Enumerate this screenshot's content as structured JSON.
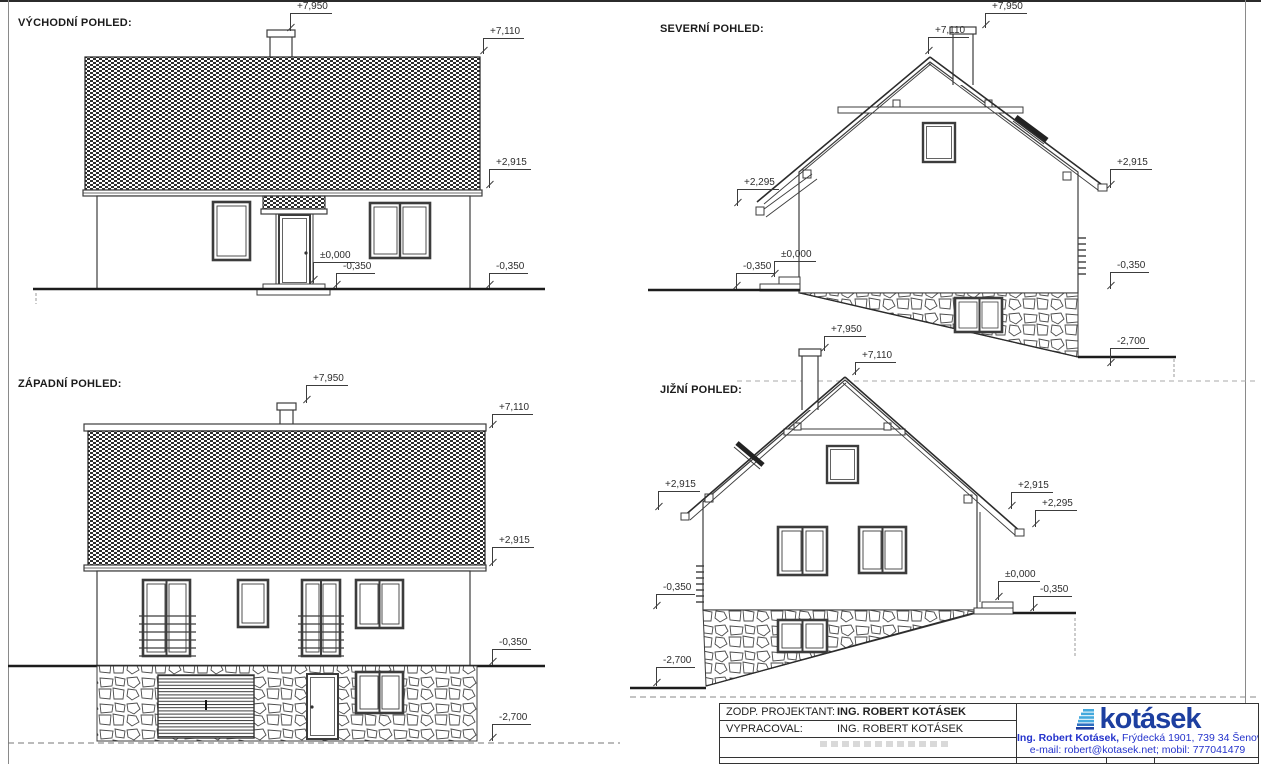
{
  "views": {
    "east": {
      "label": "VÝCHODNÍ POHLED:",
      "marks": {
        "chimney": "+7,950",
        "ridge": "+7,110",
        "eave": "+2,915",
        "zero": "±0,000",
        "ground_near": "-0,350",
        "ground": "-0,350"
      }
    },
    "north": {
      "label": "SEVERNÍ POHLED:",
      "marks": {
        "chimney": "+7,950",
        "ridge": "+7,110",
        "porch_eave": "+2,295",
        "ground_left": "-0,350",
        "zero": "±0,000",
        "eave": "+2,915",
        "ground_right": "-0,350",
        "basement": "-2,700"
      }
    },
    "west": {
      "label": "ZÁPADNÍ POHLED:",
      "marks": {
        "chimney": "+7,950",
        "ridge": "+7,110",
        "eave": "+2,915",
        "ground": "-0,350",
        "basement": "-2,700"
      }
    },
    "south": {
      "label": "JIŽNÍ POHLED:",
      "marks": {
        "chimney": "+7,950",
        "ridge": "+7,110",
        "eave_left": "+2,915",
        "ground_left": "-0,350",
        "basement_left": "-2,700",
        "eave_right": "+2,915",
        "porch_eave": "+2,295",
        "zero": "±0,000",
        "ground_right": "-0,350"
      }
    }
  },
  "titleblock": {
    "rows": [
      {
        "label": "ZODP. PROJEKTANT:",
        "value": "ING. ROBERT KOTÁSEK"
      },
      {
        "label": "VYPRACOVAL:",
        "value": "ING. ROBERT KOTÁSEK"
      }
    ],
    "logo_text": "kotásek",
    "address_name": "Ing. Robert Kotásek,",
    "address_rest": " Frýdecká 1901, 739 34 Šenov",
    "contact": "e-mail: robert@kotasek.net; mobil: 777041479",
    "colors": {
      "logo_blue": "#1d3fa0",
      "icon_blue": "#44a9dd",
      "text_blue": "#2433cc"
    }
  }
}
